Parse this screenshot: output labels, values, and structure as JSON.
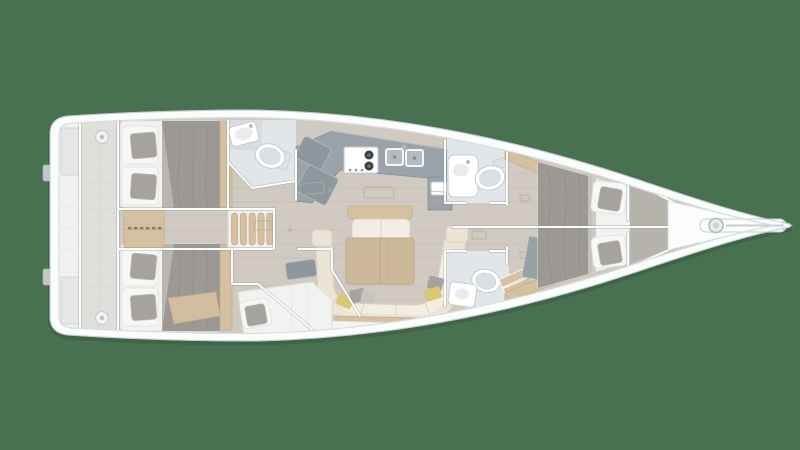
{
  "image": {
    "type": "yacht-interior-floorplan",
    "orientation": "bow-right",
    "view": "top-down"
  },
  "features": [
    "transom-platform",
    "cockpit-deck",
    "aft-cabin-port",
    "aft-cabin-starboard",
    "companionway-steps",
    "dresser",
    "aft-head",
    "galley",
    "salon",
    "salon-table",
    "salon-sofa",
    "single-berth-cabin",
    "corridor",
    "forward-head-port",
    "forward-head-starboard",
    "wardrobe",
    "forward-cabin",
    "anchor-locker",
    "bowsprit"
  ],
  "colors": {
    "bg": "#48714F",
    "hullWhite": "#fbfcfc",
    "hullLine": "#c6cdd1",
    "deckLine": "#d9dee1",
    "floorBase": "#d0cac2",
    "floorPlank": "#c0bab2",
    "floorForward": "#b6b3ad",
    "cockpitPlank": "#d8d7d3",
    "cockpitSeam": "#c6c5c1",
    "transom": "#ecedee",
    "trimWhite": "#fafbfb",
    "trimShadow": "#8d959b",
    "counterGrey": "#9aa2aa",
    "counterDark": "#868e96",
    "panelGrey": "#8f979e",
    "wardrobeGrey": "#99a0a6",
    "headFloor": "#e3e6e8",
    "fixtureWhite": "#ffffff",
    "fixtureLine": "#c6cbce",
    "toiletLid": "#dde0e2",
    "mattress": "#f2f2f0",
    "mattressLine": "#e0e0dc",
    "duvet": "#9c9995",
    "duvetFold": "#8b8884",
    "duvetLight": "#b9b6b2",
    "cushionGrey": "#a5a2a0",
    "pillowWhite": "#f7f7f5",
    "wood": "#d5c0a0",
    "woodDark": "#c0ab8a",
    "tableWood": "#cbb999",
    "sofaCream": "#ece5d5",
    "sofaSeat": "#f3eee1",
    "sofaLine": "#d9d1bf",
    "pillowYellow": "#d9c878",
    "pillowGreyLt": "#c6c3c0",
    "hatchLine": "#b0aaa2",
    "steelGrey": "#b5babd",
    "burnerDark": "#3c3f42",
    "overlay": "rgba(255,255,255,0.22)",
    "shadow": "rgba(20,40,25,0.30)"
  }
}
